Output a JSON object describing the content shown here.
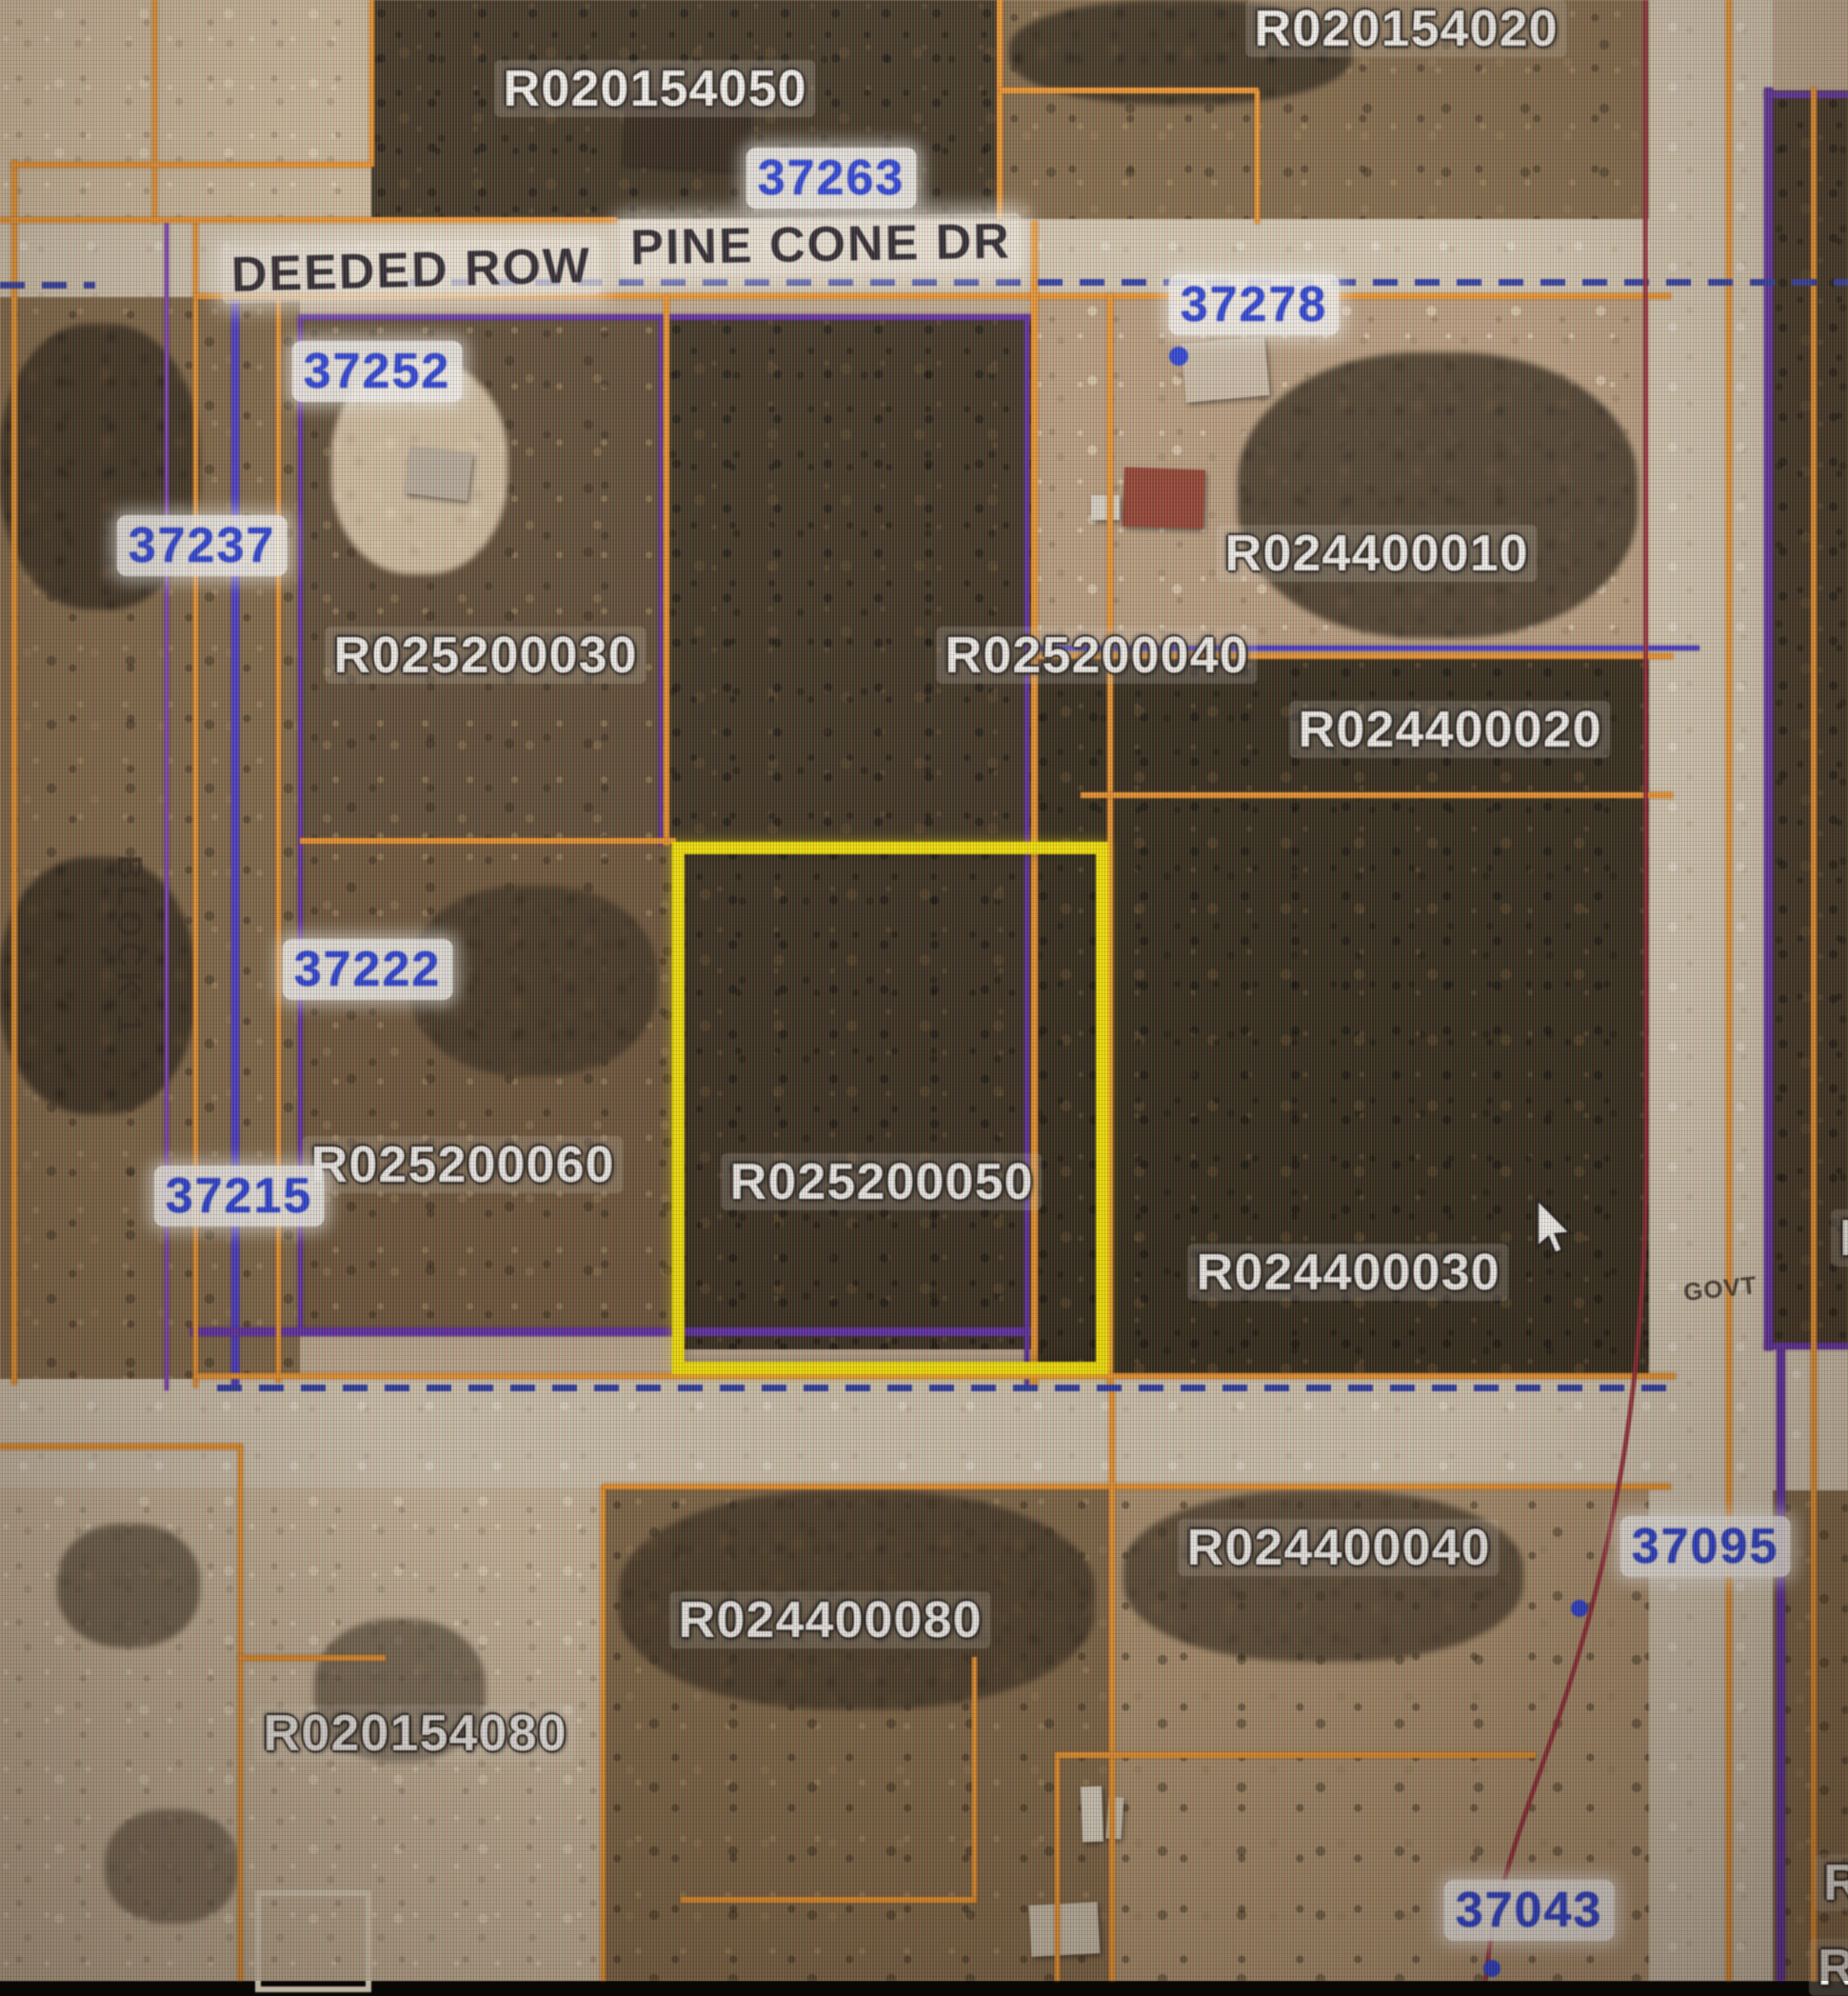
{
  "map_labels": {
    "streets": [
      {
        "name": "DEEDED ROW"
      },
      {
        "name": "PINE CONE DR"
      }
    ],
    "block_label": "BLOCK 1",
    "govt_label": "GOVT",
    "parcels": [
      {
        "id": "R020154050"
      },
      {
        "id": "R020154020"
      },
      {
        "id": "R024400010"
      },
      {
        "id": "R025200030"
      },
      {
        "id": "R025200040"
      },
      {
        "id": "R024400020"
      },
      {
        "id": "R025200060"
      },
      {
        "id": "R025200050"
      },
      {
        "id": "R024400030"
      },
      {
        "id": "R024400040"
      },
      {
        "id": "R024400080"
      },
      {
        "id": "R020154080"
      }
    ],
    "partial_parcels": [
      {
        "id": "R"
      },
      {
        "id": "R"
      },
      {
        "id": "R"
      }
    ],
    "addresses": [
      {
        "number": "37263"
      },
      {
        "number": "37252"
      },
      {
        "number": "37278"
      },
      {
        "number": "37237"
      },
      {
        "number": "37222"
      },
      {
        "number": "37215"
      },
      {
        "number": "37095"
      },
      {
        "number": "37043"
      }
    ]
  },
  "selection": {
    "selected_parcel_id": "R025200050",
    "highlight_color": "#f6e400"
  },
  "legend_colors": {
    "parcel_boundary": "#e8932f",
    "subdivision_boundary": "#5c2d9e",
    "road_centerline_dashed": "#2c3a9e",
    "highway_centerline": "#8e2330",
    "address_point": "#2940cf",
    "parcel_label": "#f3f1ec"
  }
}
